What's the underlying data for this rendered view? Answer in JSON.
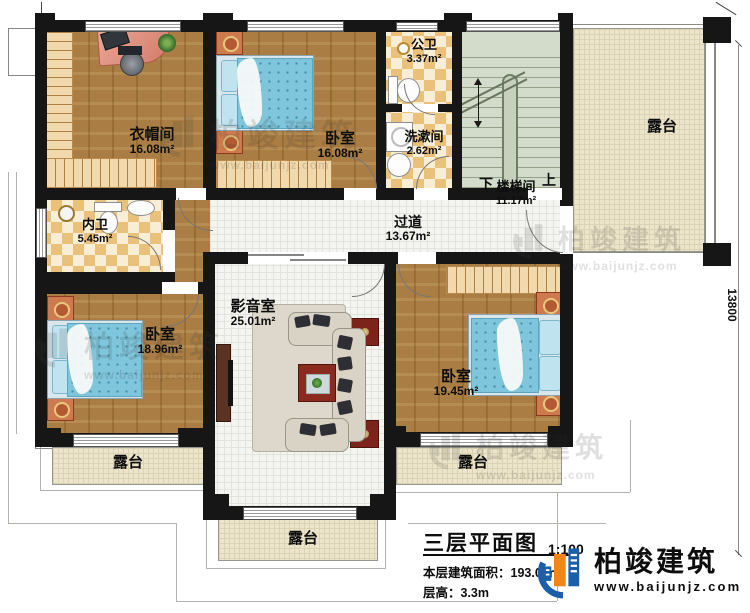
{
  "plan": {
    "rooms": {
      "cloakroom": {
        "name": "衣帽间",
        "area": "16.08m²"
      },
      "bedroom_top": {
        "name": "卧室",
        "area": "16.08m²"
      },
      "public_bath": {
        "name": "公卫",
        "area": "3.37m²"
      },
      "washroom": {
        "name": "洗漱间",
        "area": "2.62m²"
      },
      "stairwell": {
        "name": "楼梯间",
        "area": "11.17m²",
        "down": "下",
        "up": "上"
      },
      "private_bath": {
        "name": "内卫",
        "area": "5.45m²"
      },
      "hallway": {
        "name": "过道",
        "area": "13.67m²"
      },
      "media_room": {
        "name": "影音室",
        "area": "25.01m²"
      },
      "bedroom_left": {
        "name": "卧室",
        "area": "18.96m²"
      },
      "bedroom_right": {
        "name": "卧室",
        "area": "19.45m²"
      },
      "terrace": {
        "name": "露台"
      }
    },
    "dimension_right": "13800"
  },
  "title_block": {
    "title": "三层平面图",
    "scale": "1:100",
    "area_label": "本层建筑面积：193.05㎡",
    "height_label": "层高：3.3m"
  },
  "brand": {
    "name": "柏竣建筑",
    "url": "www.baijunjz.com"
  },
  "colors": {
    "wall": "#161616",
    "wood_floor": "#a97d43",
    "tile_dark": "#e9c17b",
    "tile_light": "#f8eed6",
    "bed_blue": "#7fc5db",
    "terrace_beige": "#ece5cb",
    "stair_green": "#d3dbcb",
    "logo_blue": "#1b5ea9",
    "logo_orange": "#f08519"
  }
}
